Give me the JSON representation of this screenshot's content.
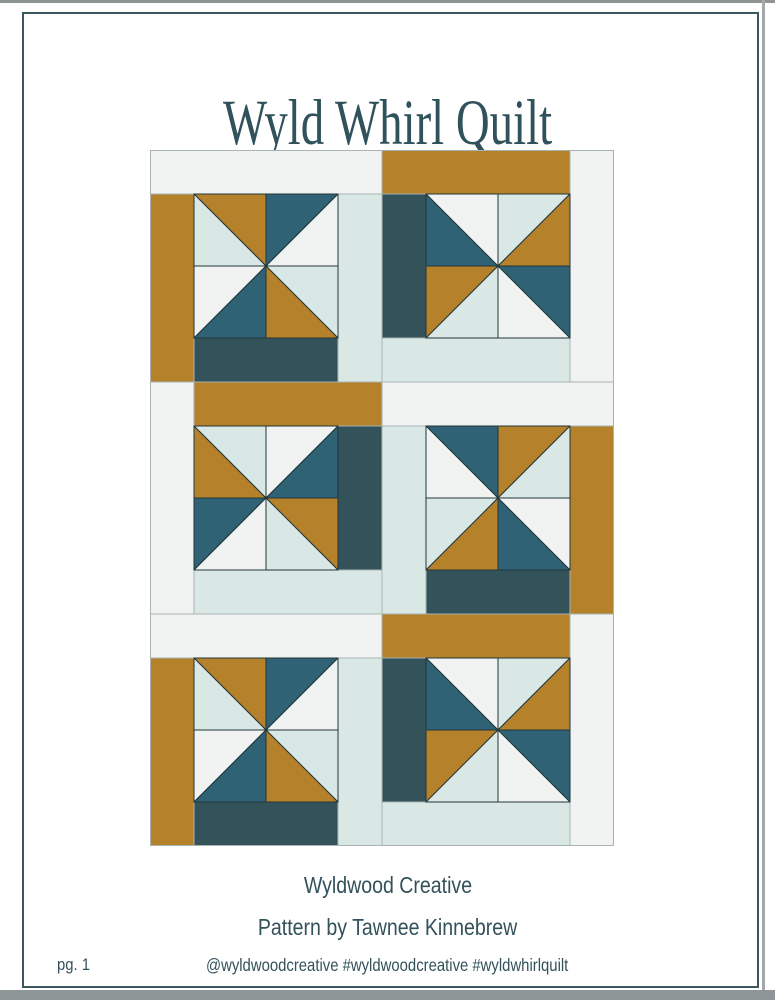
{
  "page": {
    "title": "Wyld Whirl Quilt",
    "credit_line1": "Wyldwood Creative",
    "credit_line2": "Pattern by Tawnee Kinnebrew",
    "footer_page_number": "pg. 1",
    "footer_social": "@wyldwoodcreative #wyldwoodcreative #wyldwhirlquilt",
    "border_color": "#3d575e",
    "text_color": "#33515a",
    "title_color": "#2f525b"
  },
  "quilt": {
    "cols": 2,
    "rows": 3,
    "block_size": 232,
    "strip": 44,
    "palette": {
      "paper": "#f0f3f2",
      "mint": "#d9e8e4",
      "gold": "#b5812b",
      "teal": "#2e6274",
      "darkteal": "#34525a"
    },
    "seam_color": "#a9b4b2",
    "outline_color": "#22363a",
    "blocks": [
      {
        "name": "block-1-top-left",
        "arrangement": "top-span",
        "strips": {
          "top": "paper",
          "left": "gold",
          "right": "mint",
          "bottom": "darkteal"
        },
        "pinwheel": {
          "tl": {
            "diag": "bs",
            "c1": "gold",
            "c2": "mint"
          },
          "tr": {
            "diag": "fs",
            "c1": "teal",
            "c2": "paper"
          },
          "bl": {
            "diag": "fs",
            "c1": "paper",
            "c2": "teal"
          },
          "br": {
            "diag": "bs",
            "c1": "mint",
            "c2": "gold"
          }
        }
      },
      {
        "name": "block-2-top-right",
        "arrangement": "right-span",
        "strips": {
          "top": "gold",
          "left": "darkteal",
          "right": "paper",
          "bottom": "mint"
        },
        "pinwheel": {
          "tl": {
            "diag": "bs",
            "c1": "paper",
            "c2": "teal"
          },
          "tr": {
            "diag": "fs",
            "c1": "mint",
            "c2": "gold"
          },
          "bl": {
            "diag": "fs",
            "c1": "gold",
            "c2": "mint"
          },
          "br": {
            "diag": "bs",
            "c1": "teal",
            "c2": "paper"
          }
        }
      },
      {
        "name": "block-3-middle-left",
        "arrangement": "left-span",
        "strips": {
          "top": "gold",
          "left": "paper",
          "right": "darkteal",
          "bottom": "mint"
        },
        "pinwheel": {
          "tl": {
            "diag": "bs",
            "c1": "mint",
            "c2": "gold"
          },
          "tr": {
            "diag": "fs",
            "c1": "paper",
            "c2": "teal"
          },
          "bl": {
            "diag": "fs",
            "c1": "teal",
            "c2": "paper"
          },
          "br": {
            "diag": "bs",
            "c1": "gold",
            "c2": "mint"
          }
        }
      },
      {
        "name": "block-4-middle-right",
        "arrangement": "top-span",
        "strips": {
          "top": "paper",
          "left": "mint",
          "right": "gold",
          "bottom": "darkteal"
        },
        "pinwheel": {
          "tl": {
            "diag": "bs",
            "c1": "teal",
            "c2": "paper"
          },
          "tr": {
            "diag": "fs",
            "c1": "gold",
            "c2": "mint"
          },
          "bl": {
            "diag": "fs",
            "c1": "mint",
            "c2": "gold"
          },
          "br": {
            "diag": "bs",
            "c1": "paper",
            "c2": "teal"
          }
        }
      },
      {
        "name": "block-5-bottom-left",
        "arrangement": "top-span",
        "strips": {
          "top": "paper",
          "left": "gold",
          "right": "mint",
          "bottom": "darkteal"
        },
        "pinwheel": {
          "tl": {
            "diag": "bs",
            "c1": "gold",
            "c2": "mint"
          },
          "tr": {
            "diag": "fs",
            "c1": "teal",
            "c2": "paper"
          },
          "bl": {
            "diag": "fs",
            "c1": "paper",
            "c2": "teal"
          },
          "br": {
            "diag": "bs",
            "c1": "mint",
            "c2": "gold"
          }
        }
      },
      {
        "name": "block-6-bottom-right",
        "arrangement": "right-span",
        "strips": {
          "top": "gold",
          "left": "darkteal",
          "right": "paper",
          "bottom": "mint"
        },
        "pinwheel": {
          "tl": {
            "diag": "bs",
            "c1": "paper",
            "c2": "teal"
          },
          "tr": {
            "diag": "fs",
            "c1": "mint",
            "c2": "gold"
          },
          "bl": {
            "diag": "fs",
            "c1": "gold",
            "c2": "mint"
          },
          "br": {
            "diag": "bs",
            "c1": "teal",
            "c2": "paper"
          }
        }
      }
    ]
  }
}
